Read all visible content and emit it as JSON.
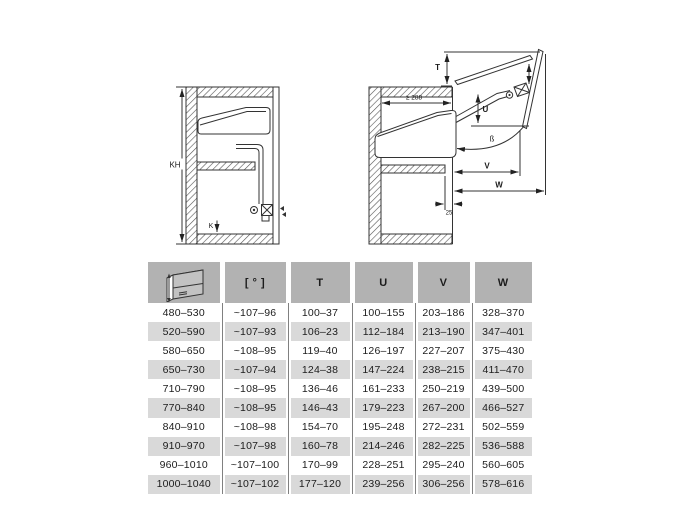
{
  "diagrams": {
    "closed": {
      "height_label": "KH",
      "bottom_label": "K"
    },
    "open": {
      "top_label": "T",
      "up_label": "U",
      "v_label": "V",
      "w_label": "W",
      "depth_label": "≥ 288",
      "angle_label": "ß",
      "inset_label": "25"
    }
  },
  "table": {
    "columns": [
      "",
      "[ ° ]",
      "T",
      "U",
      "V",
      "W"
    ],
    "rows": [
      [
        "480–530",
        "~107–96",
        "100–37",
        "100–155",
        "203–186",
        "328–370"
      ],
      [
        "520–590",
        "~107–93",
        "106–23",
        "112–184",
        "213–190",
        "347–401"
      ],
      [
        "580–650",
        "~108–95",
        "119–40",
        "126–197",
        "227–207",
        "375–430"
      ],
      [
        "650–730",
        "~107–94",
        "124–38",
        "147–224",
        "238–215",
        "411–470"
      ],
      [
        "710–790",
        "~108–95",
        "136–46",
        "161–233",
        "250–219",
        "439–500"
      ],
      [
        "770–840",
        "~108–95",
        "146–43",
        "179–223",
        "267–200",
        "466–527"
      ],
      [
        "840–910",
        "~108–98",
        "154–70",
        "195–248",
        "272–231",
        "502–559"
      ],
      [
        "910–970",
        "~107–98",
        "160–78",
        "214–246",
        "282–225",
        "536–588"
      ],
      [
        "960–1010",
        "~107–100",
        "170–99",
        "228–251",
        "295–240",
        "560–605"
      ],
      [
        "1000–1040",
        "~107–102",
        "177–120",
        "239–256",
        "306–256",
        "578–616"
      ]
    ]
  },
  "colors": {
    "header_bg": "#b2b2b2",
    "row_alt_bg": "#d9d9d9",
    "line": "#333333",
    "text": "#1c1c1c"
  }
}
